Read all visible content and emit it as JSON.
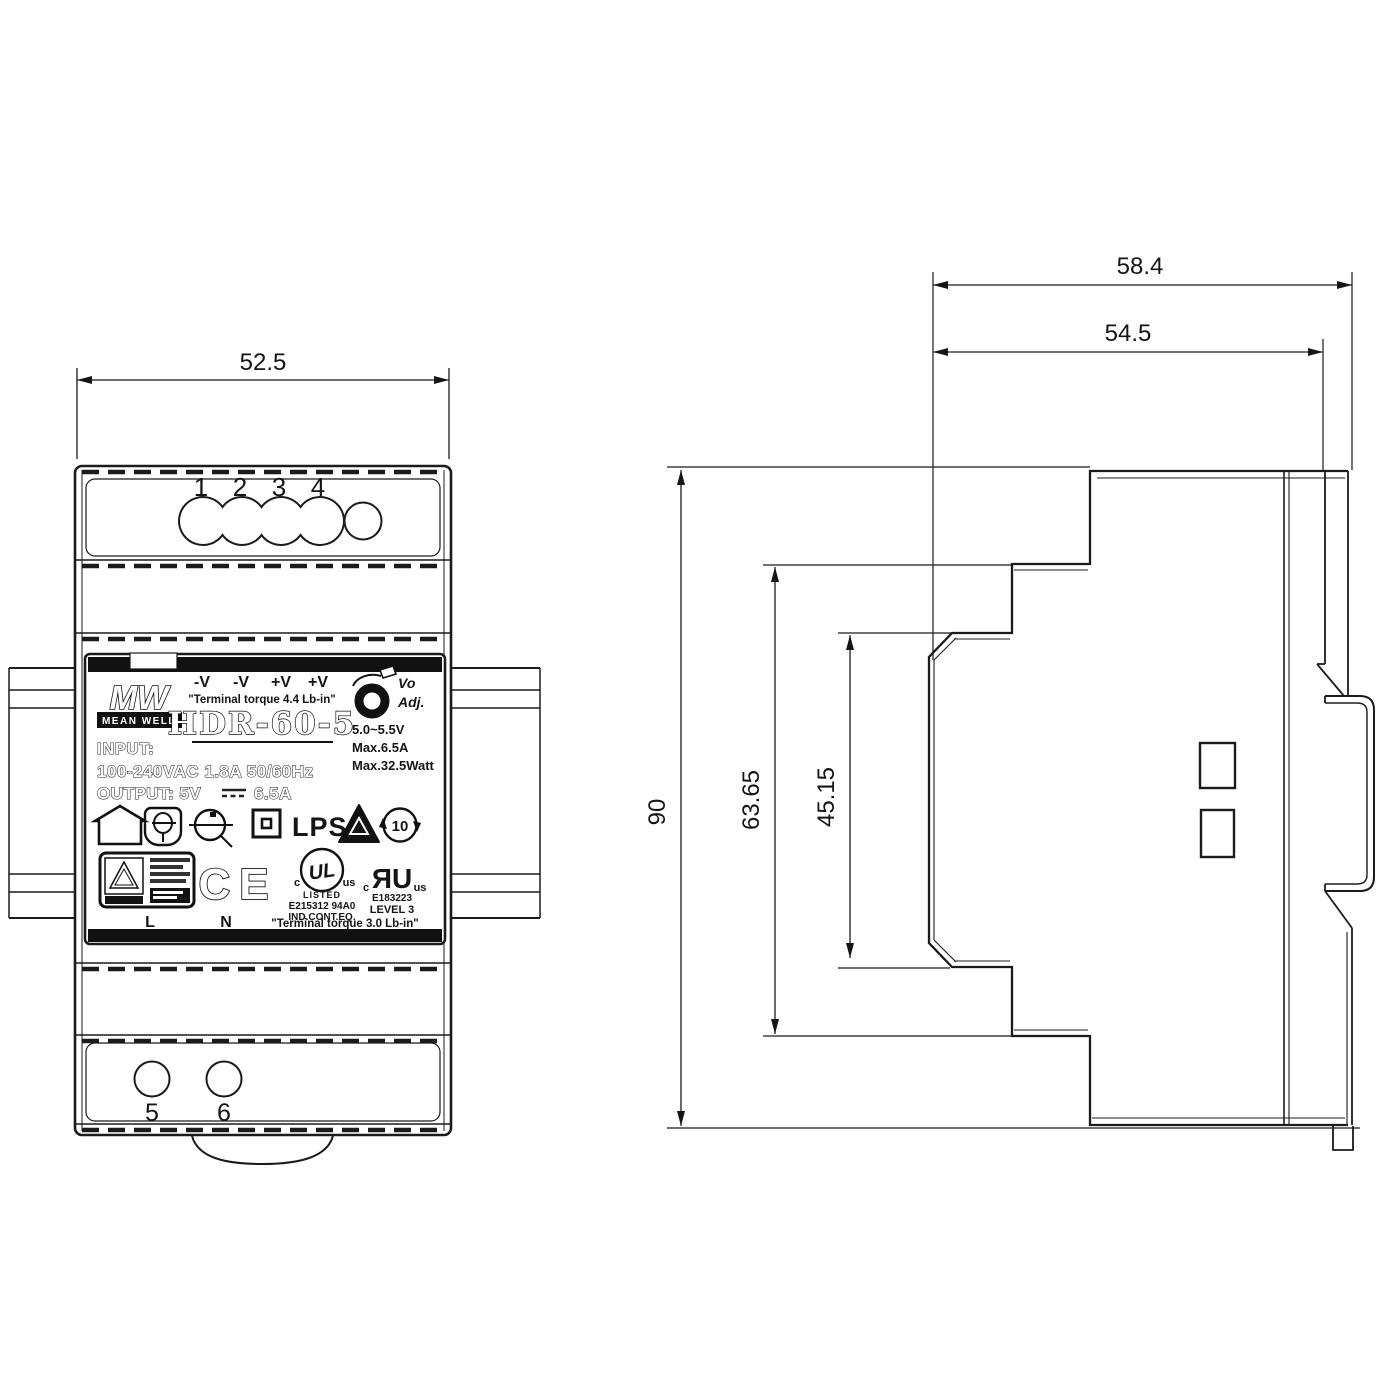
{
  "front_view": {
    "width_dim": "52.5",
    "top_terminals": [
      "1",
      "2",
      "3",
      "4"
    ],
    "bottom_terminals": [
      "5",
      "6"
    ],
    "label": {
      "logo_text": "MW",
      "brand": "MEAN WELL",
      "terminal_marks": [
        "-V",
        "-V",
        "+V",
        "+V"
      ],
      "torque_note_top": "\"Terminal torque 4.4 Lb-in\"",
      "model": "HDR-60-5",
      "vo": "Vo",
      "adj": "Adj.",
      "v_adjust_range": "5.0~5.5V",
      "max_current": "Max.6.5A",
      "max_power": "Max.32.5Watt",
      "input_heading": "INPUT:",
      "input_rating": "100-240VAC 1.8A 50/60Hz",
      "output_heading": "OUTPUT: 5V",
      "output_current": "6.5A",
      "lps": "LPS",
      "rohs_years": "10",
      "ce_mark": "CE",
      "ul_listed": {
        "c": "c",
        "ul": "UL",
        "us": "us",
        "listed": "LISTED",
        "file_no": "E215312 94A0",
        "category": "IND.CONT.EQ."
      },
      "ul_recognized": {
        "c": "c",
        "ru": "ЯU",
        "us": "us",
        "file_no": "E183223",
        "level": "LEVEL 3"
      },
      "line": "L",
      "neutral": "N",
      "torque_note_bottom": "\"Terminal torque 3.0 Lb-in\""
    }
  },
  "side_view": {
    "depth_with_rail": "58.4",
    "depth_body": "54.5",
    "height": "90",
    "depth_mid": "63.65",
    "depth_front": "45.15"
  }
}
